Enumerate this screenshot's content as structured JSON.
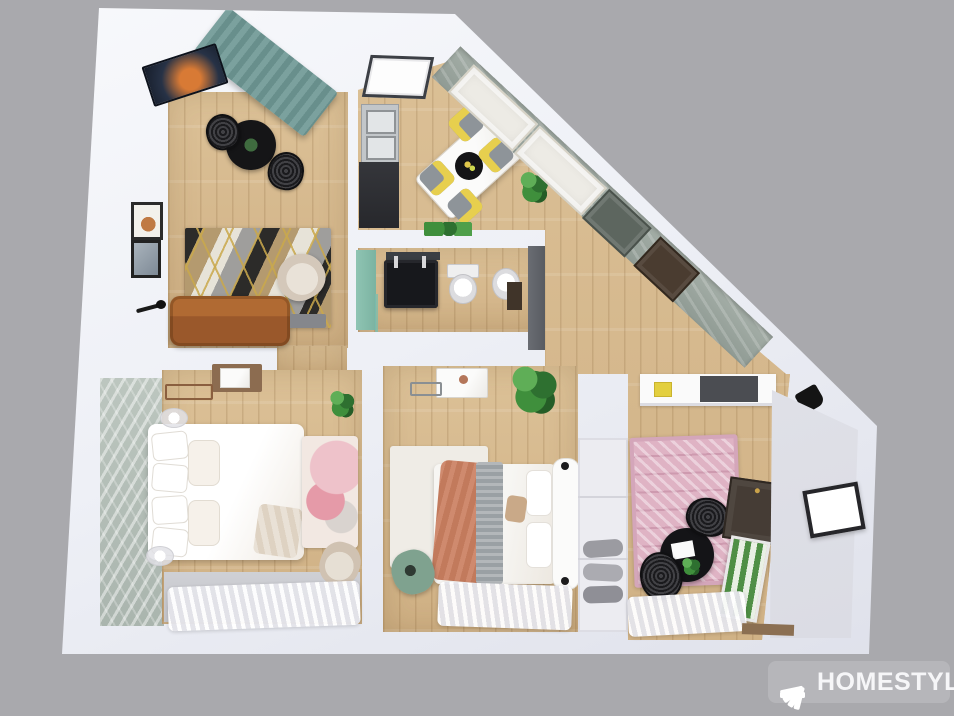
{
  "scene": {
    "renderer_watermark": "HOMESTYLER",
    "view": "3D top-down floor plan render"
  },
  "watermark": {
    "label": "HOMESTYLER",
    "icon": "homestyler-fan-icon"
  },
  "palette": {
    "background": "#a9a9ad",
    "walls": "#f0f1f7",
    "wood_floor": "#d6b88c",
    "teal_curtain": "#7ba19e",
    "sofa_leather": "#ad6735",
    "chair_cushion_yellow": "#e7cf4e",
    "rug_pink": "#dfb6c6",
    "accent_wall_teal": "#85bcab",
    "plant_green": "#3f8f3c"
  },
  "rooms": [
    {
      "name": "Living Room",
      "furniture": [
        "wall TV",
        "teal curtains",
        "black bistro table",
        "2 rattan chairs",
        "geometric chevron rug",
        "cognac leather sofa",
        "beige armchair",
        "floor lamp",
        "2 wall frames",
        "speaker"
      ]
    },
    {
      "name": "Kitchen / Dining",
      "furniture": [
        "skylight",
        "steel sink counter",
        "dark base cabinet",
        "white dining table",
        "4 chairs with yellow cushions",
        "black centerpiece tray",
        "potted palm",
        "sage feature wall",
        "2 white wardrobe panels",
        "interior door",
        "entry door"
      ]
    },
    {
      "name": "Bathroom",
      "furniture": [
        "teal accent wall",
        "black double vanity",
        "mirror",
        "wall-hung toilet",
        "bidet",
        "glass shower screen",
        "side cabinet"
      ]
    },
    {
      "name": "Hallway / Entry",
      "furniture": [
        "gray wardrobe",
        "monstera plant"
      ]
    },
    {
      "name": "Bedroom 1",
      "furniture": [
        "leaf-pattern wallpaper",
        "double bed with white bedding",
        "2 glass bedside lamps",
        "wooden sideboard",
        "luggage rack",
        "blush art rug",
        "beige bench",
        "monstera plant",
        "sheer window curtains"
      ]
    },
    {
      "name": "Bedroom 2",
      "furniture": [
        "white area rug",
        "bed with tufted headboard",
        "terracotta throw",
        "gray knit runner",
        "marble-top dresser",
        "copper table lamp",
        "sage lounge chair",
        "large potted plant",
        "sheer window curtains"
      ]
    },
    {
      "name": "Bedroom 3 / Study",
      "furniture": [
        "white counter with dark top",
        "pink berber rug",
        "black round table",
        "2 rattan chairs",
        "dark brown door",
        "leaning botanical artwork",
        "wall spotlight",
        "sheer window curtains"
      ]
    },
    {
      "name": "Balcony",
      "furniture": [
        "framed window",
        "wooden threshold"
      ]
    }
  ]
}
